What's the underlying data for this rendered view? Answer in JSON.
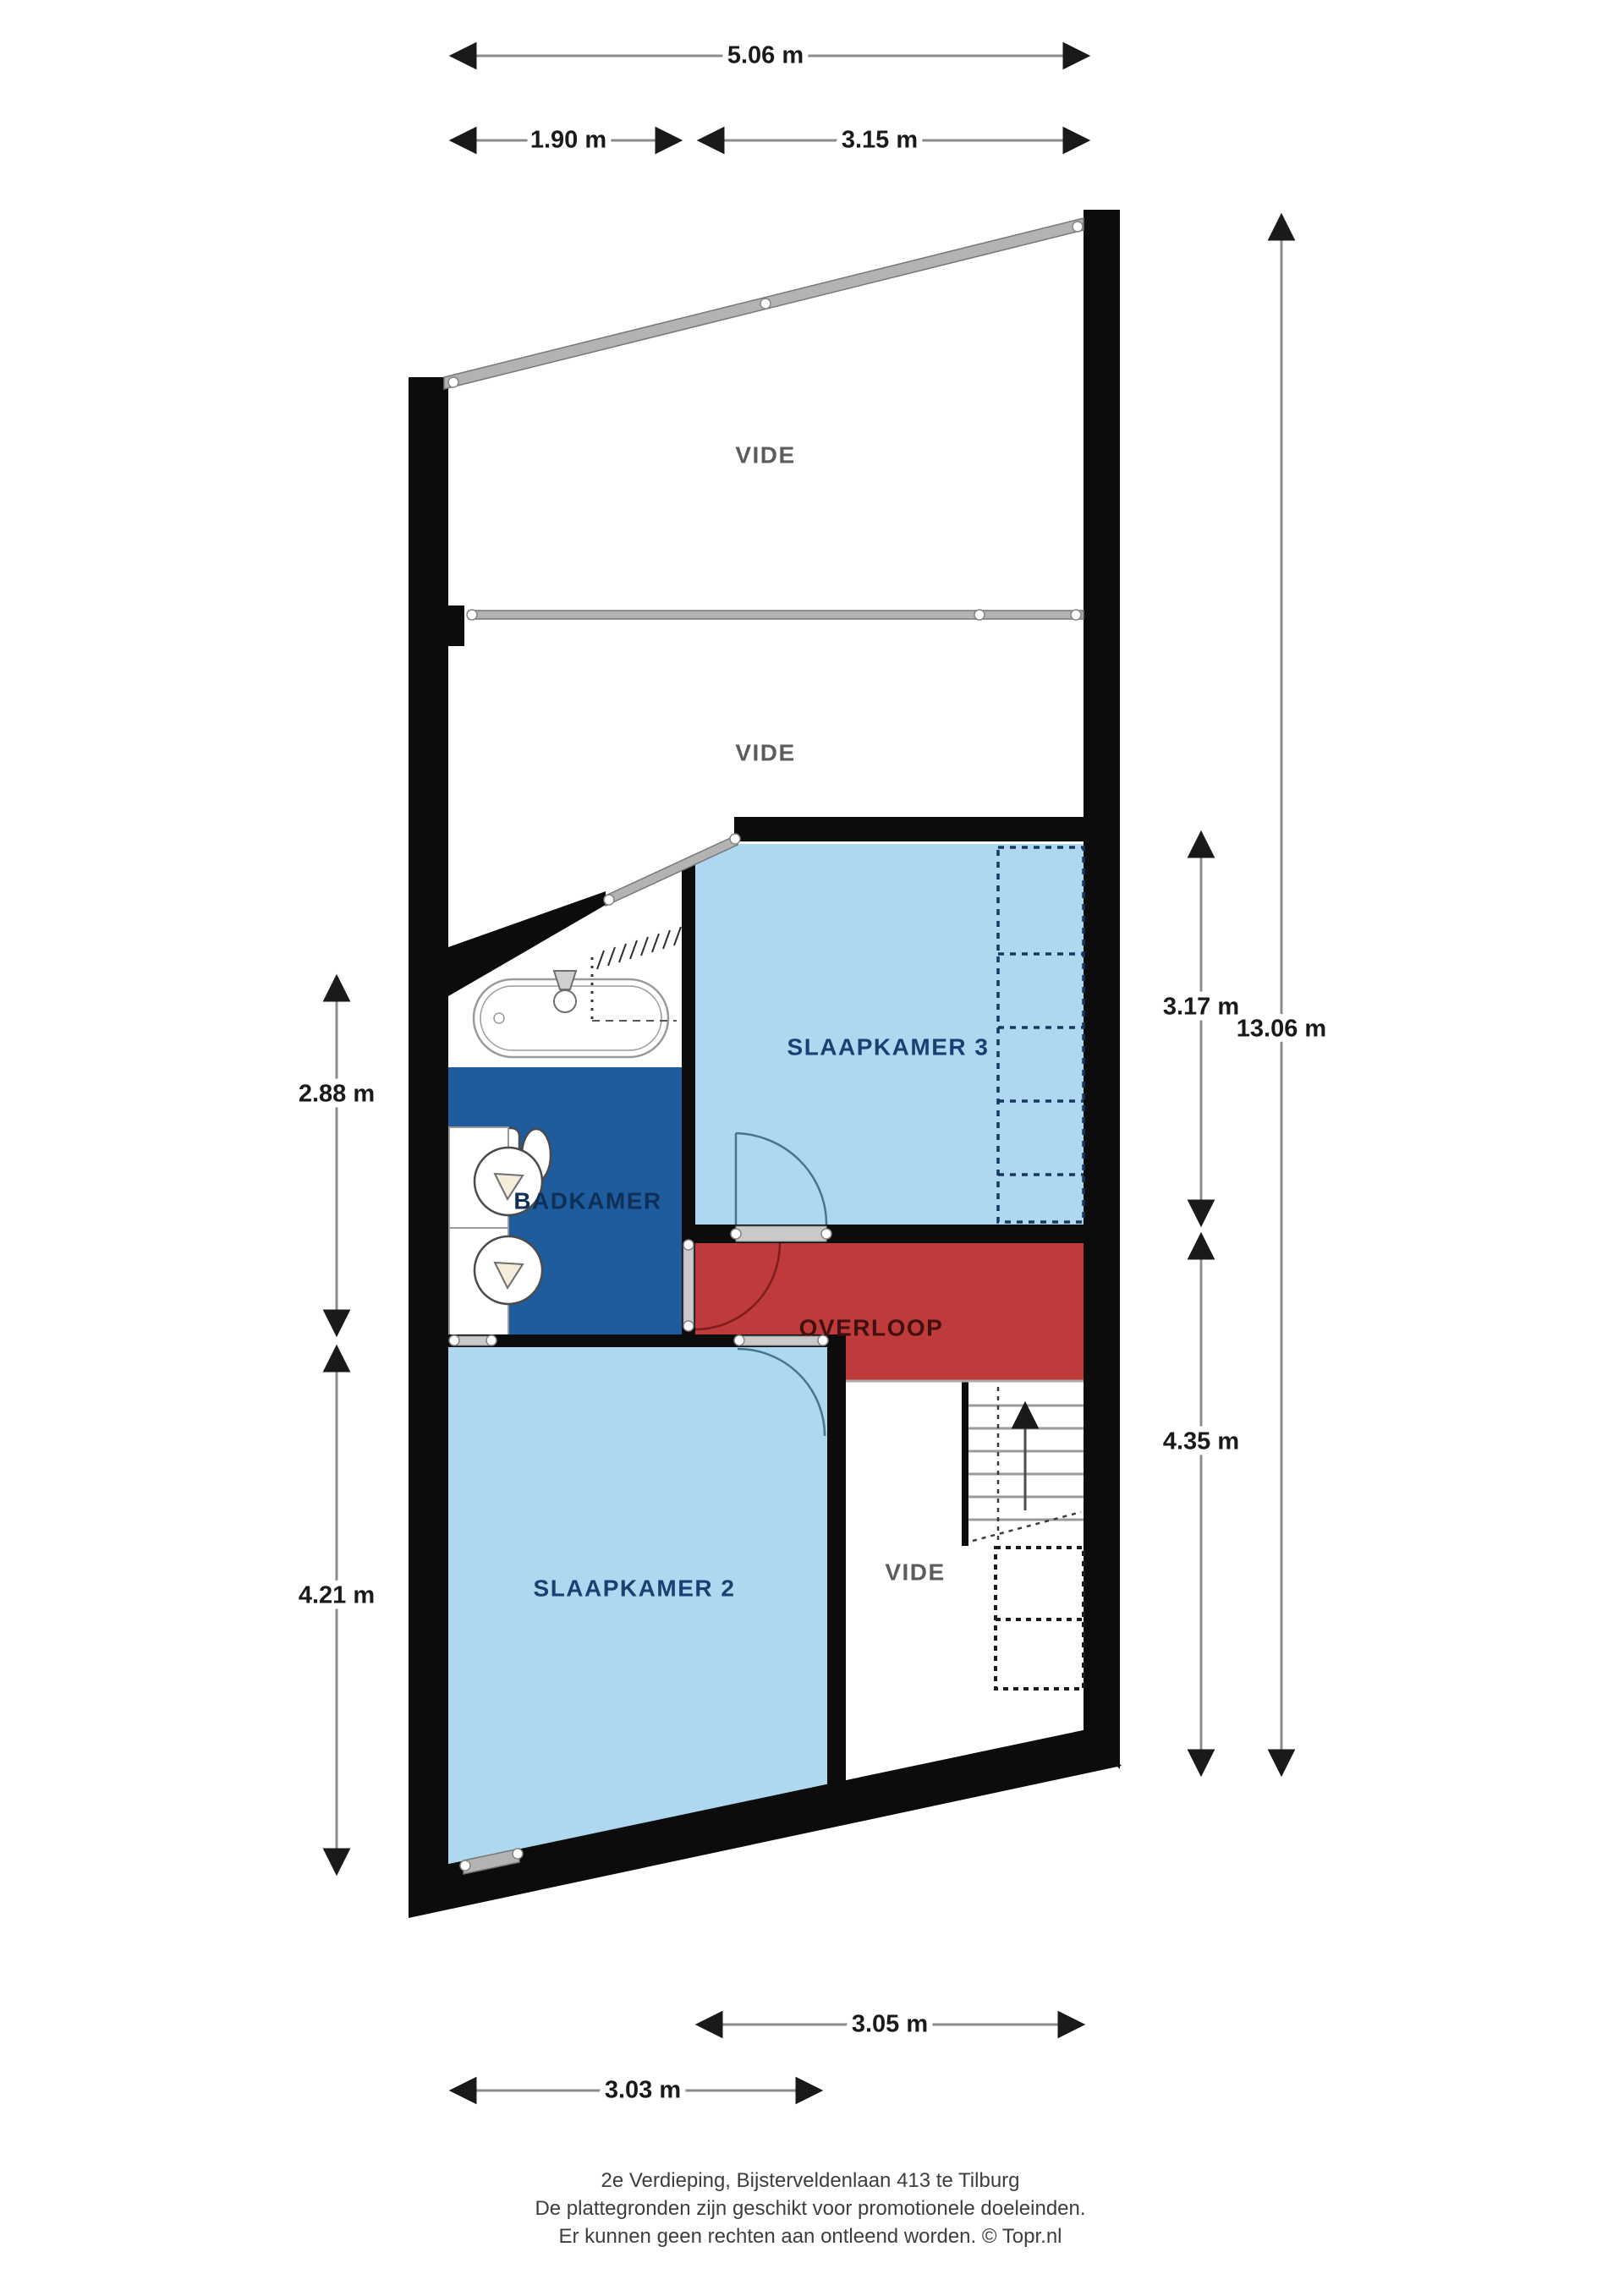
{
  "title": "2e Verdieping floor plan",
  "rooms": {
    "vide_top": {
      "label": "VIDE"
    },
    "vide_mid": {
      "label": "VIDE"
    },
    "slaapkamer3": {
      "label": "SLAAPKAMER 3"
    },
    "badkamer": {
      "label": "BADKAMER"
    },
    "overloop": {
      "label": "OVERLOOP"
    },
    "slaapkamer2": {
      "label": "SLAAPKAMER 2"
    },
    "vide_bottom": {
      "label": "VIDE"
    }
  },
  "dimensions": {
    "top_total": "5.06 m",
    "top_left": "1.90 m",
    "top_right": "3.15 m",
    "left_upper": "2.88 m",
    "left_lower": "4.21 m",
    "right_upper": "3.17 m",
    "right_total": "13.06 m",
    "right_lower": "4.35 m",
    "bottom_inner": "3.05 m",
    "bottom_outer": "3.03 m"
  },
  "footer": {
    "line1": "2e Verdieping, Bijsterveldenlaan 413 te Tilburg",
    "line2": "De plattegronden zijn geschikt voor promotionele doeleinden.",
    "line3": "Er kunnen geen rechten aan ontleend worden. © Topr.nl"
  },
  "colors": {
    "room_light_blue": "#aed8f0",
    "room_dark_blue": "#1f5c9d",
    "room_red": "#bf3a3a",
    "wall_black": "#0c0c0c",
    "glass_gray": "#b3b3b3",
    "dimension_gray": "#8c8c8c"
  }
}
